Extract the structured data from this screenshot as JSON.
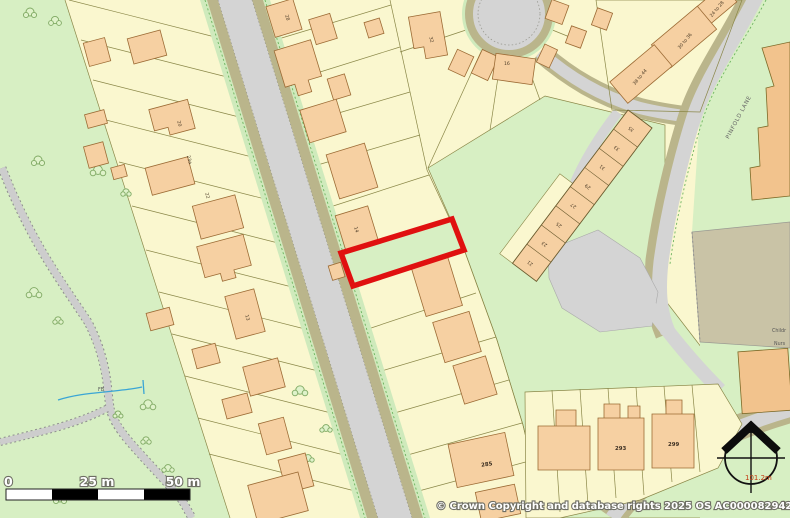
{
  "map": {
    "attribution": "© Crown Copyright and database rights 2025 OS AC0000829429",
    "scale_bar": {
      "zero": "0",
      "mid": "25 m",
      "end": "50 m"
    },
    "spot_height": "101.2m",
    "road_label": "PINFOLD LANE",
    "footbridge_label": "FB",
    "nursery_label": {
      "line1": "Childr",
      "line2": "Nurs"
    },
    "house_numbers": {
      "n13": "13",
      "n14": "14",
      "n16": "16",
      "n20": "20",
      "n22": "22",
      "n23a": "23a",
      "n28": "28",
      "n32": "32",
      "n285": "285",
      "n293": "293",
      "n299": "299",
      "r24_28": "24 to 28",
      "r30_36": "30 to 36",
      "r38_44": "38 to 44"
    },
    "terrace_numbers": [
      "35",
      "33",
      "31",
      "29",
      "27",
      "25",
      "23",
      "21"
    ],
    "colors": {
      "boundary_red": "#E01010",
      "plot_yellow": "#FAF7CF",
      "grass_green": "#D7EFC3",
      "building_peach": "#F6D0A2",
      "road_grey": "#D4D4D4",
      "verge_olive": "#BAB58B"
    }
  }
}
